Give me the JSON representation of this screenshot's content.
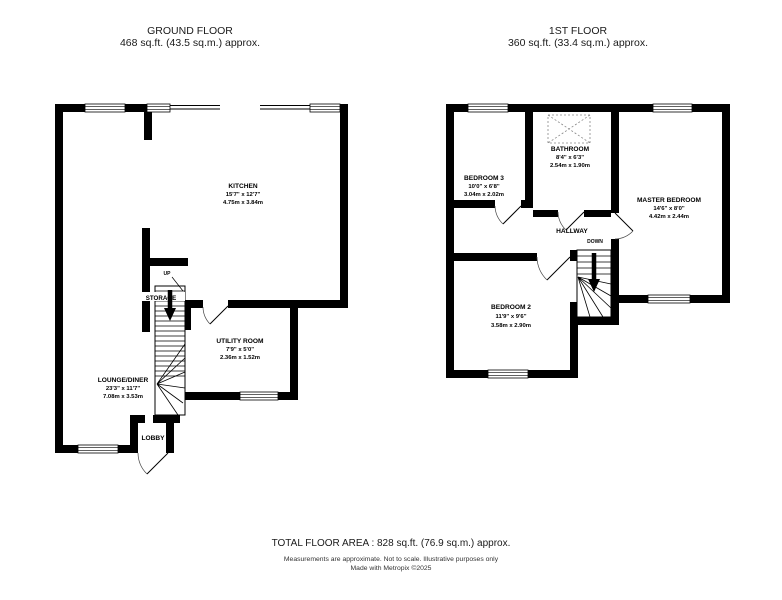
{
  "headers": {
    "ground": {
      "title": "GROUND FLOOR",
      "area": "468 sq.ft. (43.5 sq.m.) approx."
    },
    "first": {
      "title": "1ST FLOOR",
      "area": "360 sq.ft. (33.4 sq.m.) approx."
    }
  },
  "ground_floor": {
    "kitchen": {
      "name": "KITCHEN",
      "imperial": "15'7\" x 12'7\"",
      "metric": "4.75m x 3.84m"
    },
    "utility": {
      "name": "UTILITY ROOM",
      "imperial": "7'9\" x 5'0\"",
      "metric": "2.36m x 1.52m"
    },
    "lounge": {
      "name": "LOUNGE/DINER",
      "imperial": "23'3\" x 11'7\"",
      "metric": "7.08m x 3.53m"
    },
    "lobby": {
      "name": "LOBBY"
    },
    "storage": {
      "name": "STORAGE"
    },
    "stairs_direction": "UP"
  },
  "first_floor": {
    "bedroom3": {
      "name": "BEDROOM 3",
      "imperial": "10'0\" x 6'8\"",
      "metric": "3.04m x 2.02m"
    },
    "bathroom": {
      "name": "BATHROOM",
      "imperial": "8'4\" x 6'3\"",
      "metric": "2.54m x 1.90m"
    },
    "master": {
      "name": "MASTER BEDROOM",
      "imperial": "14'6\" x 8'0\"",
      "metric": "4.42m x 2.44m"
    },
    "hallway": {
      "name": "HALLWAY"
    },
    "bedroom2": {
      "name": "BEDROOM 2",
      "imperial": "11'9\" x 9'6\"",
      "metric": "3.58m x 2.90m"
    },
    "stairs_direction": "DOWN"
  },
  "footer": {
    "total_area": "TOTAL FLOOR AREA : 828 sq.ft. (76.9 sq.m.) approx.",
    "disclaimer": "Measurements are approximate.  Not to scale.  Illustrative purposes only",
    "credit": "Made with Metropix ©2025"
  },
  "colors": {
    "wall": "#000000",
    "background": "#ffffff",
    "door_arc": "#444444"
  }
}
